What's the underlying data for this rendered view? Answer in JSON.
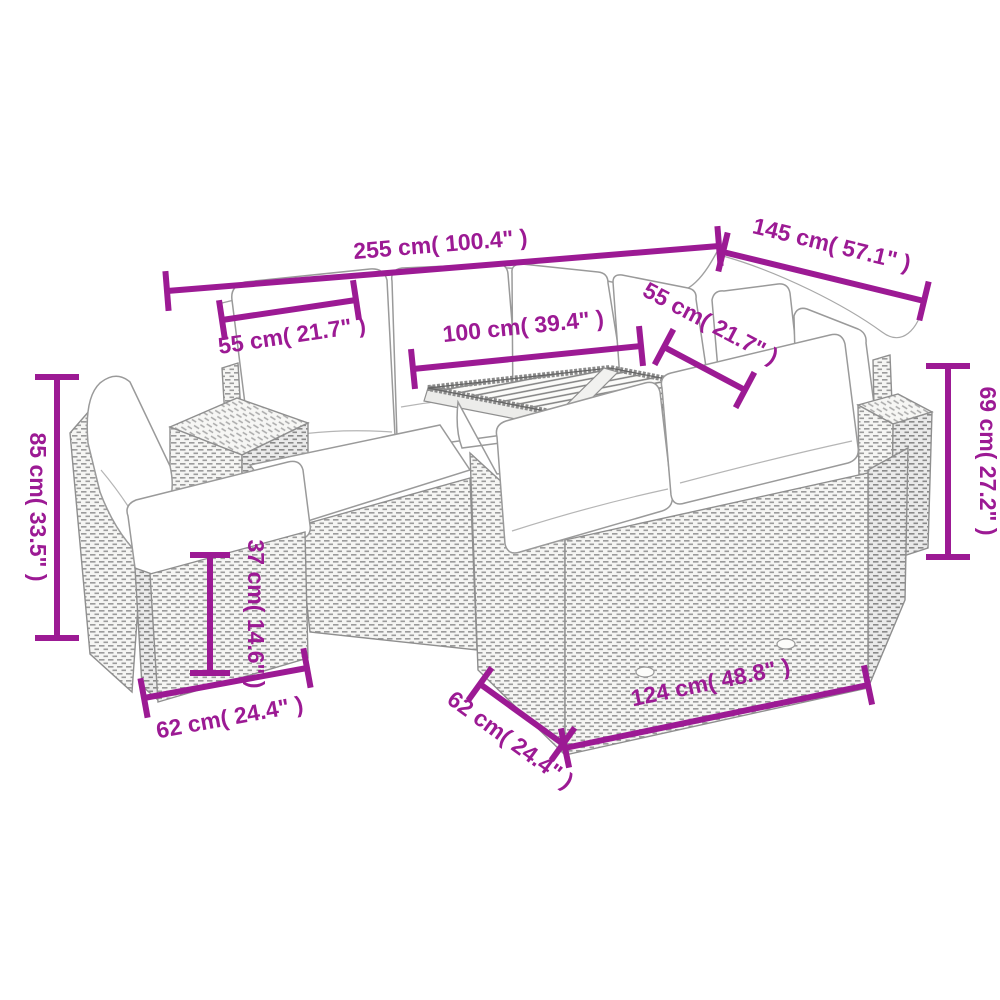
{
  "diagram": {
    "kind": "product-dimension-diagram",
    "subject": "poly-rattan garden lounge set with table and footstool",
    "accent_color": "#9C1A94",
    "line_art_color": "#8f8f8f",
    "background_color": "#ffffff",
    "dimensions": [
      {
        "id": "total-width",
        "label": "255 cm( 100.4\" )",
        "value_cm": 255,
        "value_in": 100.4,
        "orientation": "horizontal-top"
      },
      {
        "id": "right-side-width",
        "label": "145 cm( 57.1\" )",
        "value_cm": 145,
        "value_in": 57.1,
        "orientation": "diagonal-top-right"
      },
      {
        "id": "seat-width-left",
        "label": "55 cm( 21.7\" )",
        "value_cm": 55,
        "value_in": 21.7,
        "orientation": "horizontal"
      },
      {
        "id": "table-length",
        "label": "100 cm( 39.4\" )",
        "value_cm": 100,
        "value_in": 39.4,
        "orientation": "horizontal"
      },
      {
        "id": "seat-width-right",
        "label": "55 cm( 21.7\" )",
        "value_cm": 55,
        "value_in": 21.7,
        "orientation": "diagonal"
      },
      {
        "id": "back-height",
        "label": "85 cm( 33.5\" )",
        "value_cm": 85,
        "value_in": 33.5,
        "orientation": "vertical-left"
      },
      {
        "id": "sofa-height",
        "label": "69 cm( 27.2\" )",
        "value_cm": 69,
        "value_in": 27.2,
        "orientation": "vertical-right"
      },
      {
        "id": "footstool-height",
        "label": "37 cm( 14.6\" )",
        "value_cm": 37,
        "value_in": 14.6,
        "orientation": "vertical"
      },
      {
        "id": "footstool-width",
        "label": "62 cm( 24.4\" )",
        "value_cm": 62,
        "value_in": 24.4,
        "orientation": "horizontal-bottom-left"
      },
      {
        "id": "bench-depth",
        "label": "62 cm( 24.4\" )",
        "value_cm": 62,
        "value_in": 24.4,
        "orientation": "diagonal-bottom"
      },
      {
        "id": "bench-width",
        "label": "124 cm( 48.8\" )",
        "value_cm": 124,
        "value_in": 48.8,
        "orientation": "horizontal-bottom"
      }
    ]
  }
}
